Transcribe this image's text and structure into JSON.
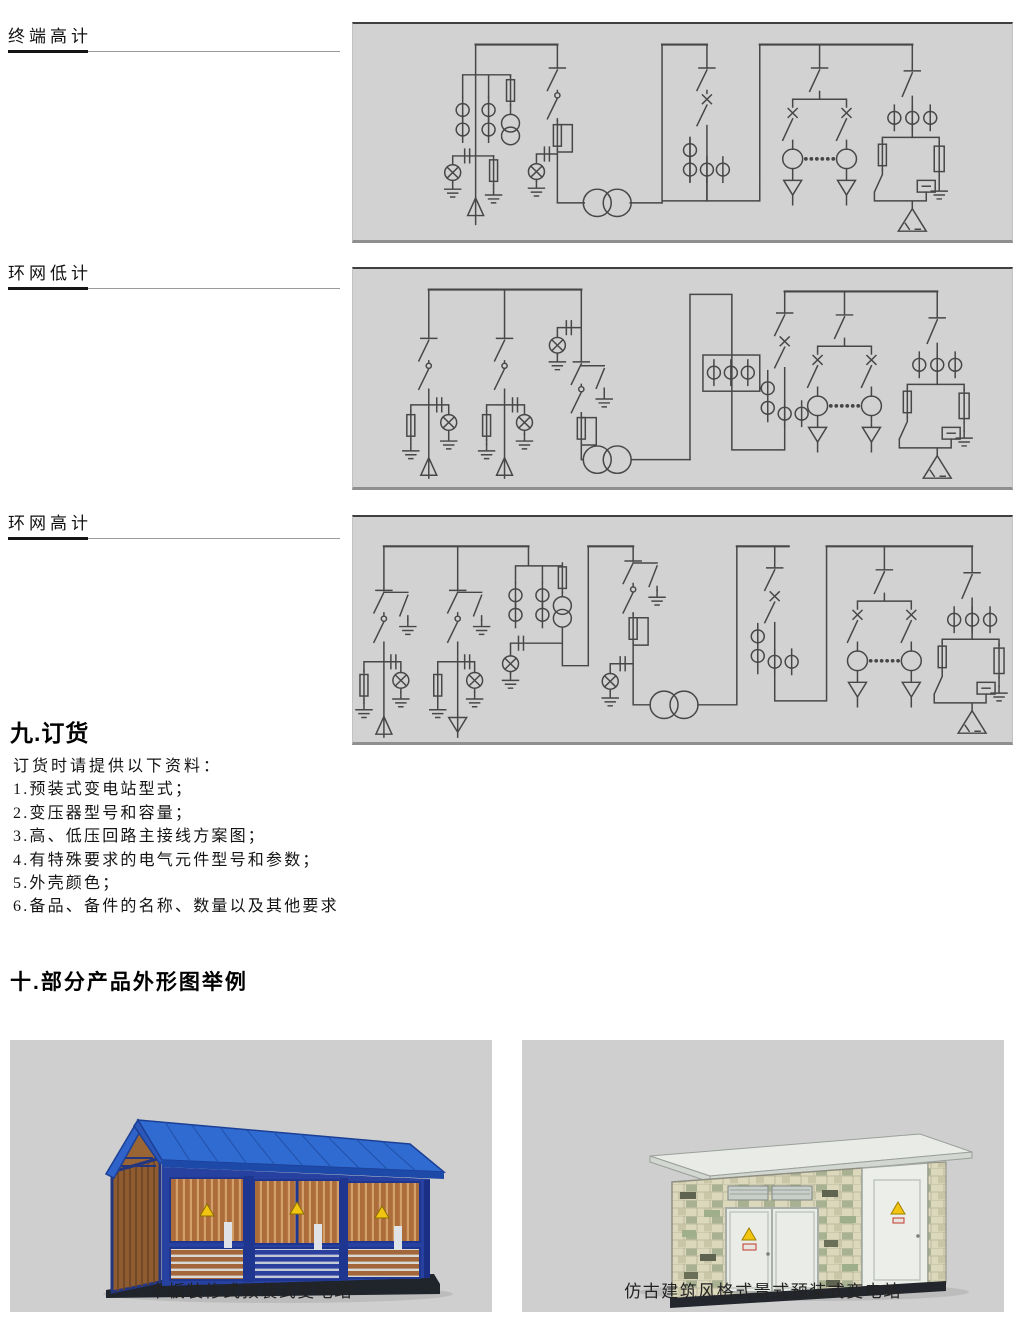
{
  "sections": {
    "schematics": [
      {
        "label": "终端高计"
      },
      {
        "label": "环网低计"
      },
      {
        "label": "环网高计"
      }
    ],
    "ordering": {
      "title": "九.订货",
      "intro": "订货时请提供以下资料：",
      "items": [
        "1.预装式变电站型式；",
        "2.变压器型号和容量；",
        "3.高、低压回路主接线方案图；",
        "4.有特殊要求的电气元件型号和参数；",
        "5.外壳颜色；",
        "6.备品、备件的名称、数量以及其他要求"
      ]
    },
    "products": {
      "title": "十.部分产品外形图举例",
      "items": [
        {
          "caption": "木板装修式预装式变电站"
        },
        {
          "caption": "仿古建筑风格式景式预装式变电站"
        }
      ]
    }
  },
  "schematic_symbols": [
    "disconnector-switch",
    "load-break-switch",
    "fuse",
    "current-transformer",
    "voltage-transformer",
    "power-transformer",
    "surge-arrester",
    "earth-ground",
    "indicator-lamp",
    "capacitor-tap",
    "delta-winding",
    "cable-termination"
  ],
  "colors": {
    "panel_background": "#d2d2d2",
    "panel_top_border": "#3f3f3f",
    "panel_bottom_border": "#8f8f8f",
    "schematic_line": "#474747",
    "photo_background": "#cfcfcf",
    "substation1_frame_blue": "#26419f",
    "substation1_roof_blue": "#2f6bd0",
    "substation1_wood": "#ad6d3a",
    "substation2_brick": "#dcd8bc",
    "substation2_brick_green": "#a8b292",
    "warning_yellow": "#f2c511",
    "base_dark": "#23262c"
  }
}
